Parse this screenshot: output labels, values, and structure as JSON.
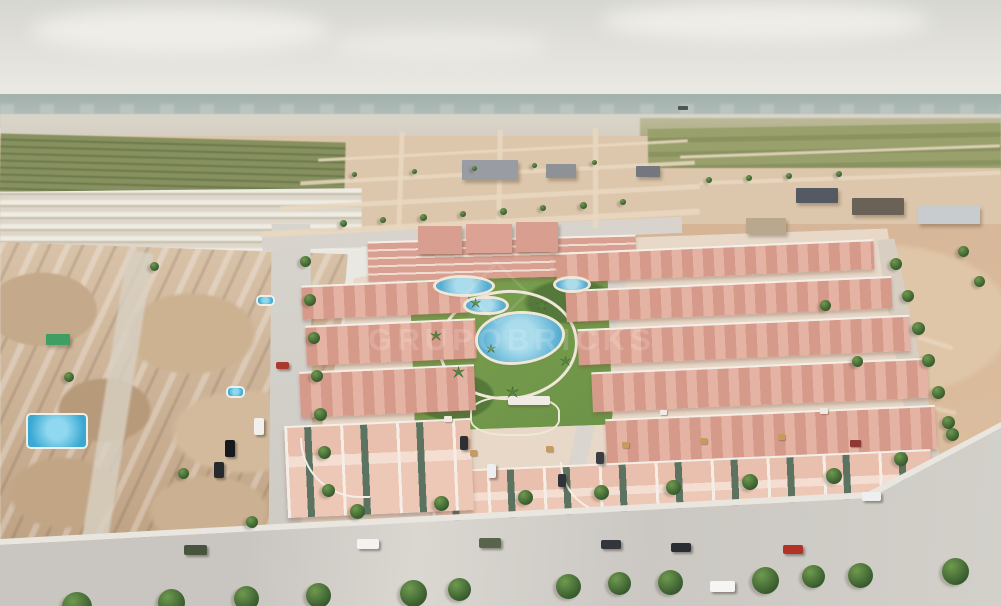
{
  "watermark": {
    "text": "GRUPOBRICKS"
  },
  "palette": {
    "sky-top": "#d7d7d2",
    "sky-bot": "#eae8e3",
    "sea-a": "#a2b1ac",
    "sea-b": "#b8c2bc",
    "haze": "#d8d2c7",
    "field": "#87905f",
    "dirt-mid": "#dcc6ac",
    "dirt-right": "#d5b496",
    "road": "#d4d1cb",
    "road-light": "#dfdcd6",
    "roof-a": "#d69a8b",
    "roof-b": "#e5b3a3",
    "trim": "#f5eee6",
    "wall": "#eec8b6",
    "window-green": "#5d7361",
    "lawn": "#7ba04f",
    "lawn-dark": "#55793a",
    "pool-a": "#57add2",
    "pool-b": "#aadcec",
    "deck": "#efe7d8",
    "oldtown-a": "#d8c2a8",
    "oldtown-b": "#bfa284",
    "tree-a": "#6f9a4f",
    "tree-b": "#35582c",
    "strip": "#ead9c1"
  },
  "scene": {
    "objects": [
      {
        "t": "strip",
        "x": 260,
        "y": 220,
        "w": 440,
        "h": 6,
        "r": -3
      },
      {
        "t": "strip",
        "x": 280,
        "y": 195,
        "w": 420,
        "h": 5,
        "r": -3
      },
      {
        "t": "strip",
        "x": 300,
        "y": 171,
        "w": 395,
        "h": 4,
        "r": -3
      },
      {
        "t": "strip",
        "x": 318,
        "y": 149,
        "w": 370,
        "h": 3,
        "r": -3
      },
      {
        "t": "strip",
        "x": 398,
        "y": 132,
        "w": 5,
        "h": 96,
        "r": 2
      },
      {
        "t": "strip",
        "x": 497,
        "y": 130,
        "w": 5,
        "h": 98,
        "r": 1
      },
      {
        "t": "strip",
        "x": 593,
        "y": 128,
        "w": 5,
        "h": 100,
        "r": 0
      },
      {
        "t": "strip",
        "x": 680,
        "y": 150,
        "w": 320,
        "h": 3,
        "r": -2
      },
      {
        "t": "strip",
        "x": 700,
        "y": 176,
        "w": 300,
        "h": 4,
        "r": -2
      },
      {
        "t": "bldg",
        "x": 462,
        "y": 160,
        "w": 56,
        "h": 20,
        "c": "#999da3"
      },
      {
        "t": "bldg",
        "x": 546,
        "y": 164,
        "w": 30,
        "h": 14,
        "c": "#8e9297"
      },
      {
        "t": "bldg",
        "x": 636,
        "y": 166,
        "w": 24,
        "h": 11,
        "c": "#74787e"
      },
      {
        "t": "bldg",
        "x": 796,
        "y": 188,
        "w": 42,
        "h": 15,
        "c": "#555a62"
      },
      {
        "t": "bldg",
        "x": 852,
        "y": 198,
        "w": 52,
        "h": 17,
        "c": "#6a6257"
      },
      {
        "t": "bldg",
        "x": 918,
        "y": 206,
        "w": 62,
        "h": 18,
        "c": "#c9ccce"
      },
      {
        "t": "bldg",
        "x": 418,
        "y": 226,
        "w": 44,
        "h": 28,
        "c": "#d89e8f"
      },
      {
        "t": "bldg",
        "x": 466,
        "y": 224,
        "w": 46,
        "h": 29,
        "c": "#dca394"
      },
      {
        "t": "bldg",
        "x": 516,
        "y": 222,
        "w": 42,
        "h": 30,
        "c": "#d89e8f"
      },
      {
        "t": "bldg",
        "x": 746,
        "y": 218,
        "w": 40,
        "h": 16,
        "c": "#b9a88e"
      },
      {
        "t": "bldg",
        "x": 46,
        "y": 334,
        "w": 24,
        "h": 11,
        "c": "#3f9e63"
      },
      {
        "t": "pool",
        "x": 478,
        "y": 314,
        "w": 84,
        "h": 48,
        "rr": "52% 48% 62% 38%/55% 42% 58% 45%"
      },
      {
        "t": "pool",
        "x": 466,
        "y": 299,
        "w": 40,
        "h": 13,
        "rr": "50%/60%"
      },
      {
        "t": "pool",
        "x": 436,
        "y": 278,
        "w": 56,
        "h": 16,
        "rr": "45% 55% 50% 50%/50%"
      },
      {
        "t": "pool",
        "x": 556,
        "y": 279,
        "w": 32,
        "h": 11,
        "rr": "50%"
      },
      {
        "t": "poolb",
        "x": 28,
        "y": 415,
        "w": 58,
        "h": 32
      },
      {
        "t": "poolb",
        "x": 258,
        "y": 297,
        "w": 15,
        "h": 7
      },
      {
        "t": "poolb",
        "x": 228,
        "y": 388,
        "w": 15,
        "h": 8
      },
      {
        "t": "ship",
        "x": 678,
        "y": 106,
        "w": 10,
        "h": 4
      },
      {
        "t": "car",
        "x": 184,
        "y": 545,
        "w": 23,
        "h": 10,
        "c": "#47553f"
      },
      {
        "t": "car",
        "x": 357,
        "y": 539,
        "w": 22,
        "h": 10,
        "c": "#f3f3f1"
      },
      {
        "t": "car",
        "x": 479,
        "y": 538,
        "w": 22,
        "h": 10,
        "c": "#59644c"
      },
      {
        "t": "car",
        "x": 601,
        "y": 540,
        "w": 20,
        "h": 9,
        "c": "#33373c"
      },
      {
        "t": "car",
        "x": 671,
        "y": 543,
        "w": 20,
        "h": 9,
        "c": "#2a2e33"
      },
      {
        "t": "car",
        "x": 783,
        "y": 545,
        "w": 20,
        "h": 9,
        "c": "#b23227"
      },
      {
        "t": "car",
        "x": 710,
        "y": 581,
        "w": 25,
        "h": 11,
        "c": "#f5f5f3"
      },
      {
        "t": "car",
        "x": 254,
        "y": 418,
        "w": 10,
        "h": 17,
        "c": "#f1f0ed"
      },
      {
        "t": "car",
        "x": 225,
        "y": 440,
        "w": 10,
        "h": 17,
        "c": "#16181b"
      },
      {
        "t": "car",
        "x": 214,
        "y": 462,
        "w": 10,
        "h": 16,
        "c": "#26292d"
      },
      {
        "t": "car",
        "x": 276,
        "y": 362,
        "w": 13,
        "h": 7,
        "c": "#a83a2e"
      },
      {
        "t": "car",
        "x": 460,
        "y": 436,
        "w": 8,
        "h": 14,
        "c": "#2c3034"
      },
      {
        "t": "car",
        "x": 487,
        "y": 464,
        "w": 9,
        "h": 14,
        "c": "#edeff0"
      },
      {
        "t": "car",
        "x": 558,
        "y": 474,
        "w": 8,
        "h": 13,
        "c": "#30343a"
      },
      {
        "t": "car",
        "x": 862,
        "y": 492,
        "w": 19,
        "h": 9,
        "c": "#eef0ef"
      },
      {
        "t": "car",
        "x": 596,
        "y": 452,
        "w": 8,
        "h": 12,
        "c": "#3a3e44"
      },
      {
        "t": "roof",
        "x": 470,
        "y": 450,
        "w": 7,
        "h": 6,
        "c": "#c79a62"
      },
      {
        "t": "roof",
        "x": 546,
        "y": 446,
        "w": 7,
        "h": 6,
        "c": "#c79a62"
      },
      {
        "t": "roof",
        "x": 622,
        "y": 442,
        "w": 7,
        "h": 6,
        "c": "#c79a62"
      },
      {
        "t": "roof",
        "x": 700,
        "y": 438,
        "w": 7,
        "h": 6,
        "c": "#c79a62"
      },
      {
        "t": "roof",
        "x": 778,
        "y": 434,
        "w": 7,
        "h": 6,
        "c": "#c79a62"
      },
      {
        "t": "roof",
        "x": 850,
        "y": 440,
        "w": 11,
        "h": 7,
        "c": "#8e3a33"
      },
      {
        "t": "roof",
        "x": 444,
        "y": 416,
        "w": 8,
        "h": 6,
        "c": "#efeae2"
      },
      {
        "t": "roof",
        "x": 660,
        "y": 410,
        "w": 7,
        "h": 5,
        "c": "#efeae2"
      },
      {
        "t": "roof",
        "x": 820,
        "y": 408,
        "w": 8,
        "h": 6,
        "c": "#efeae2"
      },
      {
        "t": "tree",
        "x": 300,
        "y": 256,
        "s": 11
      },
      {
        "t": "tree",
        "x": 304,
        "y": 294,
        "s": 12
      },
      {
        "t": "tree",
        "x": 308,
        "y": 332,
        "s": 12
      },
      {
        "t": "tree",
        "x": 311,
        "y": 370,
        "s": 12
      },
      {
        "t": "tree",
        "x": 314,
        "y": 408,
        "s": 13
      },
      {
        "t": "tree",
        "x": 318,
        "y": 446,
        "s": 13
      },
      {
        "t": "tree",
        "x": 322,
        "y": 484,
        "s": 13
      },
      {
        "t": "tree",
        "x": 350,
        "y": 504,
        "s": 15
      },
      {
        "t": "tree",
        "x": 434,
        "y": 496,
        "s": 15
      },
      {
        "t": "tree",
        "x": 518,
        "y": 490,
        "s": 15
      },
      {
        "t": "tree",
        "x": 594,
        "y": 485,
        "s": 15
      },
      {
        "t": "tree",
        "x": 666,
        "y": 480,
        "s": 15
      },
      {
        "t": "tree",
        "x": 742,
        "y": 474,
        "s": 16
      },
      {
        "t": "tree",
        "x": 826,
        "y": 468,
        "s": 16
      },
      {
        "t": "tree",
        "x": 894,
        "y": 452,
        "s": 14
      },
      {
        "t": "tree",
        "x": 946,
        "y": 428,
        "s": 13
      },
      {
        "t": "tree",
        "x": 890,
        "y": 258,
        "s": 12
      },
      {
        "t": "tree",
        "x": 902,
        "y": 290,
        "s": 12
      },
      {
        "t": "tree",
        "x": 912,
        "y": 322,
        "s": 13
      },
      {
        "t": "tree",
        "x": 922,
        "y": 354,
        "s": 13
      },
      {
        "t": "tree",
        "x": 932,
        "y": 386,
        "s": 13
      },
      {
        "t": "tree",
        "x": 942,
        "y": 416,
        "s": 13
      },
      {
        "t": "tree",
        "x": 820,
        "y": 300,
        "s": 11
      },
      {
        "t": "tree",
        "x": 852,
        "y": 356,
        "s": 11
      },
      {
        "t": "tree",
        "x": 958,
        "y": 246,
        "s": 11
      },
      {
        "t": "tree",
        "x": 974,
        "y": 276,
        "s": 11
      },
      {
        "t": "tree",
        "x": 62,
        "y": 592,
        "s": 30
      },
      {
        "t": "tree",
        "x": 158,
        "y": 589,
        "s": 27
      },
      {
        "t": "tree",
        "x": 234,
        "y": 586,
        "s": 25
      },
      {
        "t": "tree",
        "x": 306,
        "y": 583,
        "s": 25
      },
      {
        "t": "tree",
        "x": 400,
        "y": 580,
        "s": 27
      },
      {
        "t": "tree",
        "x": 448,
        "y": 578,
        "s": 23
      },
      {
        "t": "tree",
        "x": 556,
        "y": 574,
        "s": 25
      },
      {
        "t": "tree",
        "x": 608,
        "y": 572,
        "s": 23
      },
      {
        "t": "tree",
        "x": 658,
        "y": 570,
        "s": 25
      },
      {
        "t": "tree",
        "x": 752,
        "y": 567,
        "s": 27
      },
      {
        "t": "tree",
        "x": 802,
        "y": 565,
        "s": 23
      },
      {
        "t": "tree",
        "x": 848,
        "y": 563,
        "s": 25
      },
      {
        "t": "tree",
        "x": 942,
        "y": 558,
        "s": 27
      },
      {
        "t": "tree",
        "x": 340,
        "y": 220,
        "s": 7
      },
      {
        "t": "tree",
        "x": 380,
        "y": 217,
        "s": 6
      },
      {
        "t": "tree",
        "x": 420,
        "y": 214,
        "s": 7
      },
      {
        "t": "tree",
        "x": 460,
        "y": 211,
        "s": 6
      },
      {
        "t": "tree",
        "x": 500,
        "y": 208,
        "s": 7
      },
      {
        "t": "tree",
        "x": 540,
        "y": 205,
        "s": 6
      },
      {
        "t": "tree",
        "x": 580,
        "y": 202,
        "s": 7
      },
      {
        "t": "tree",
        "x": 620,
        "y": 199,
        "s": 6
      },
      {
        "t": "tree",
        "x": 352,
        "y": 172,
        "s": 5
      },
      {
        "t": "tree",
        "x": 412,
        "y": 169,
        "s": 5
      },
      {
        "t": "tree",
        "x": 472,
        "y": 166,
        "s": 5
      },
      {
        "t": "tree",
        "x": 532,
        "y": 163,
        "s": 5
      },
      {
        "t": "tree",
        "x": 592,
        "y": 160,
        "s": 5
      },
      {
        "t": "tree",
        "x": 706,
        "y": 177,
        "s": 6
      },
      {
        "t": "tree",
        "x": 746,
        "y": 175,
        "s": 6
      },
      {
        "t": "tree",
        "x": 786,
        "y": 173,
        "s": 6
      },
      {
        "t": "tree",
        "x": 836,
        "y": 171,
        "s": 6
      },
      {
        "t": "tree",
        "x": 150,
        "y": 262,
        "s": 9
      },
      {
        "t": "tree",
        "x": 64,
        "y": 372,
        "s": 10
      },
      {
        "t": "tree",
        "x": 178,
        "y": 468,
        "s": 11
      },
      {
        "t": "tree",
        "x": 246,
        "y": 516,
        "s": 12
      },
      {
        "t": "palm",
        "x": 430,
        "y": 330,
        "s": 12
      },
      {
        "t": "palm",
        "x": 452,
        "y": 366,
        "s": 13
      },
      {
        "t": "palm",
        "x": 470,
        "y": 298,
        "s": 11
      },
      {
        "t": "palm",
        "x": 506,
        "y": 386,
        "s": 13
      },
      {
        "t": "palm",
        "x": 536,
        "y": 300,
        "s": 11
      },
      {
        "t": "palm",
        "x": 486,
        "y": 344,
        "s": 10
      },
      {
        "t": "palm",
        "x": 560,
        "y": 356,
        "s": 11
      }
    ]
  }
}
